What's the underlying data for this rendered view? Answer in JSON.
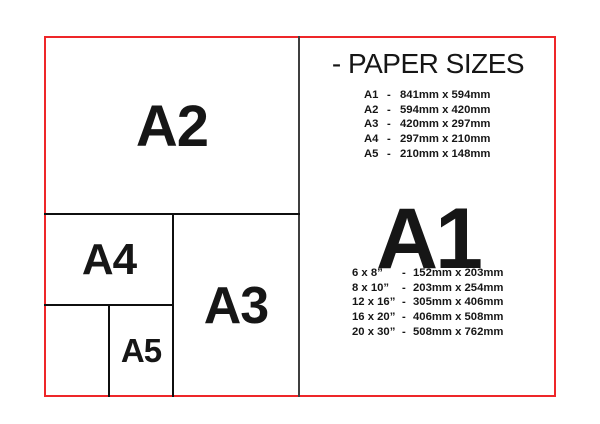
{
  "colors": {
    "frame_red": "#ee2629",
    "line_black": "#0f0f0f",
    "divider_gray": "#3f3f3f",
    "text": "#161616",
    "background": "#ffffff"
  },
  "diagram": {
    "a2_label": "A2",
    "a3_label": "A3",
    "a4_label": "A4",
    "a5_label": "A5"
  },
  "panel": {
    "title": "- PAPER SIZES",
    "featured_size": "A1",
    "a_sizes": [
      {
        "name": "A1",
        "dash": "-",
        "dims": "841mm x 594mm"
      },
      {
        "name": "A2",
        "dash": "-",
        "dims": "594mm x 420mm"
      },
      {
        "name": "A3",
        "dash": "-",
        "dims": "420mm x 297mm"
      },
      {
        "name": "A4",
        "dash": "-",
        "dims": "297mm x 210mm"
      },
      {
        "name": "A5",
        "dash": "-",
        "dims": "210mm x 148mm"
      }
    ],
    "inch_sizes": [
      {
        "name": "6 x 8”",
        "dash": "-",
        "dims": "152mm x 203mm"
      },
      {
        "name": "8 x 10”",
        "dash": "-",
        "dims": "203mm x 254mm"
      },
      {
        "name": "12 x 16”",
        "dash": "-",
        "dims": "305mm x 406mm"
      },
      {
        "name": "16 x 20”",
        "dash": "-",
        "dims": "406mm x 508mm"
      },
      {
        "name": "20 x 30”",
        "dash": "-",
        "dims": "508mm x 762mm"
      }
    ]
  }
}
